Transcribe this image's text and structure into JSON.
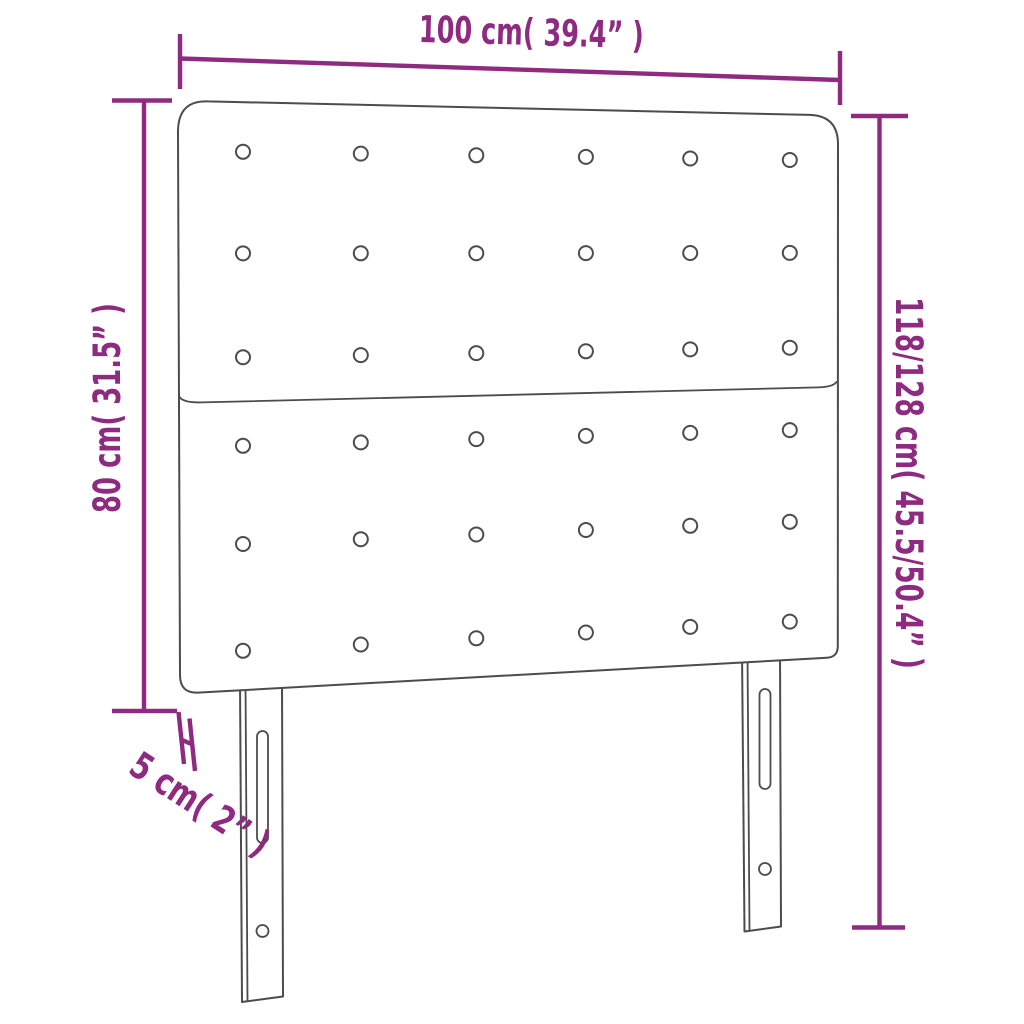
{
  "diagram": {
    "labels": {
      "width": "100 cm( 39.4” )",
      "total_height": "118/128 cm( 45.5/50.4” )",
      "panel_height": "80 cm( 31.5” )",
      "depth": "5 cm( 2” )"
    },
    "colors": {
      "dimension": "#8e2a80",
      "outline": "#4c4c4c",
      "background": "#ffffff"
    },
    "structure": {
      "panels": 2,
      "button_rows_per_panel": 3,
      "button_columns": 6,
      "legs": 2
    }
  }
}
